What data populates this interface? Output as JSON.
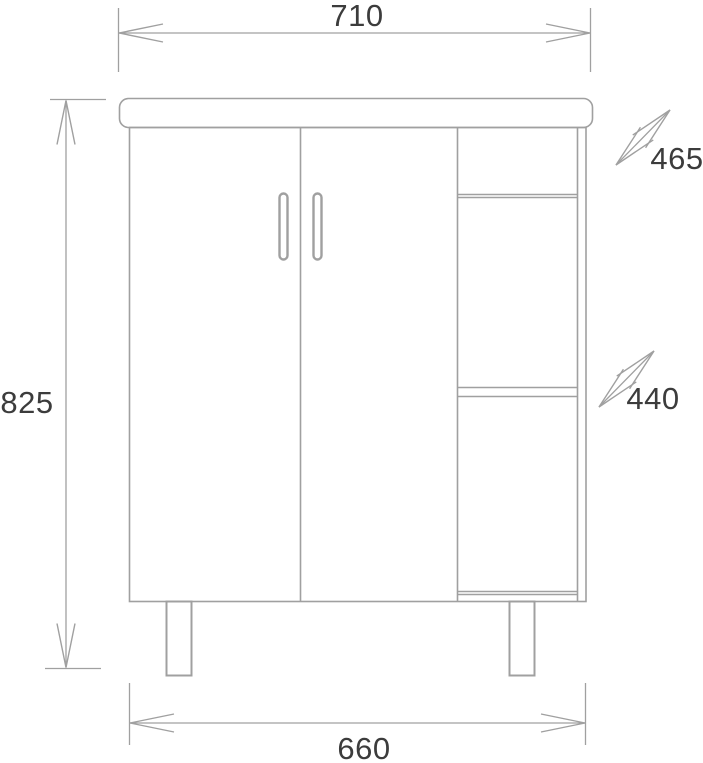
{
  "diagram": {
    "dimensions": {
      "top_width": "710",
      "left_height": "825",
      "bottom_width": "660",
      "upper_right": "465",
      "lower_right": "440"
    },
    "colors": {
      "line": "#a0a0a0",
      "text": "#3c3c3c",
      "background": "#ffffff"
    }
  }
}
